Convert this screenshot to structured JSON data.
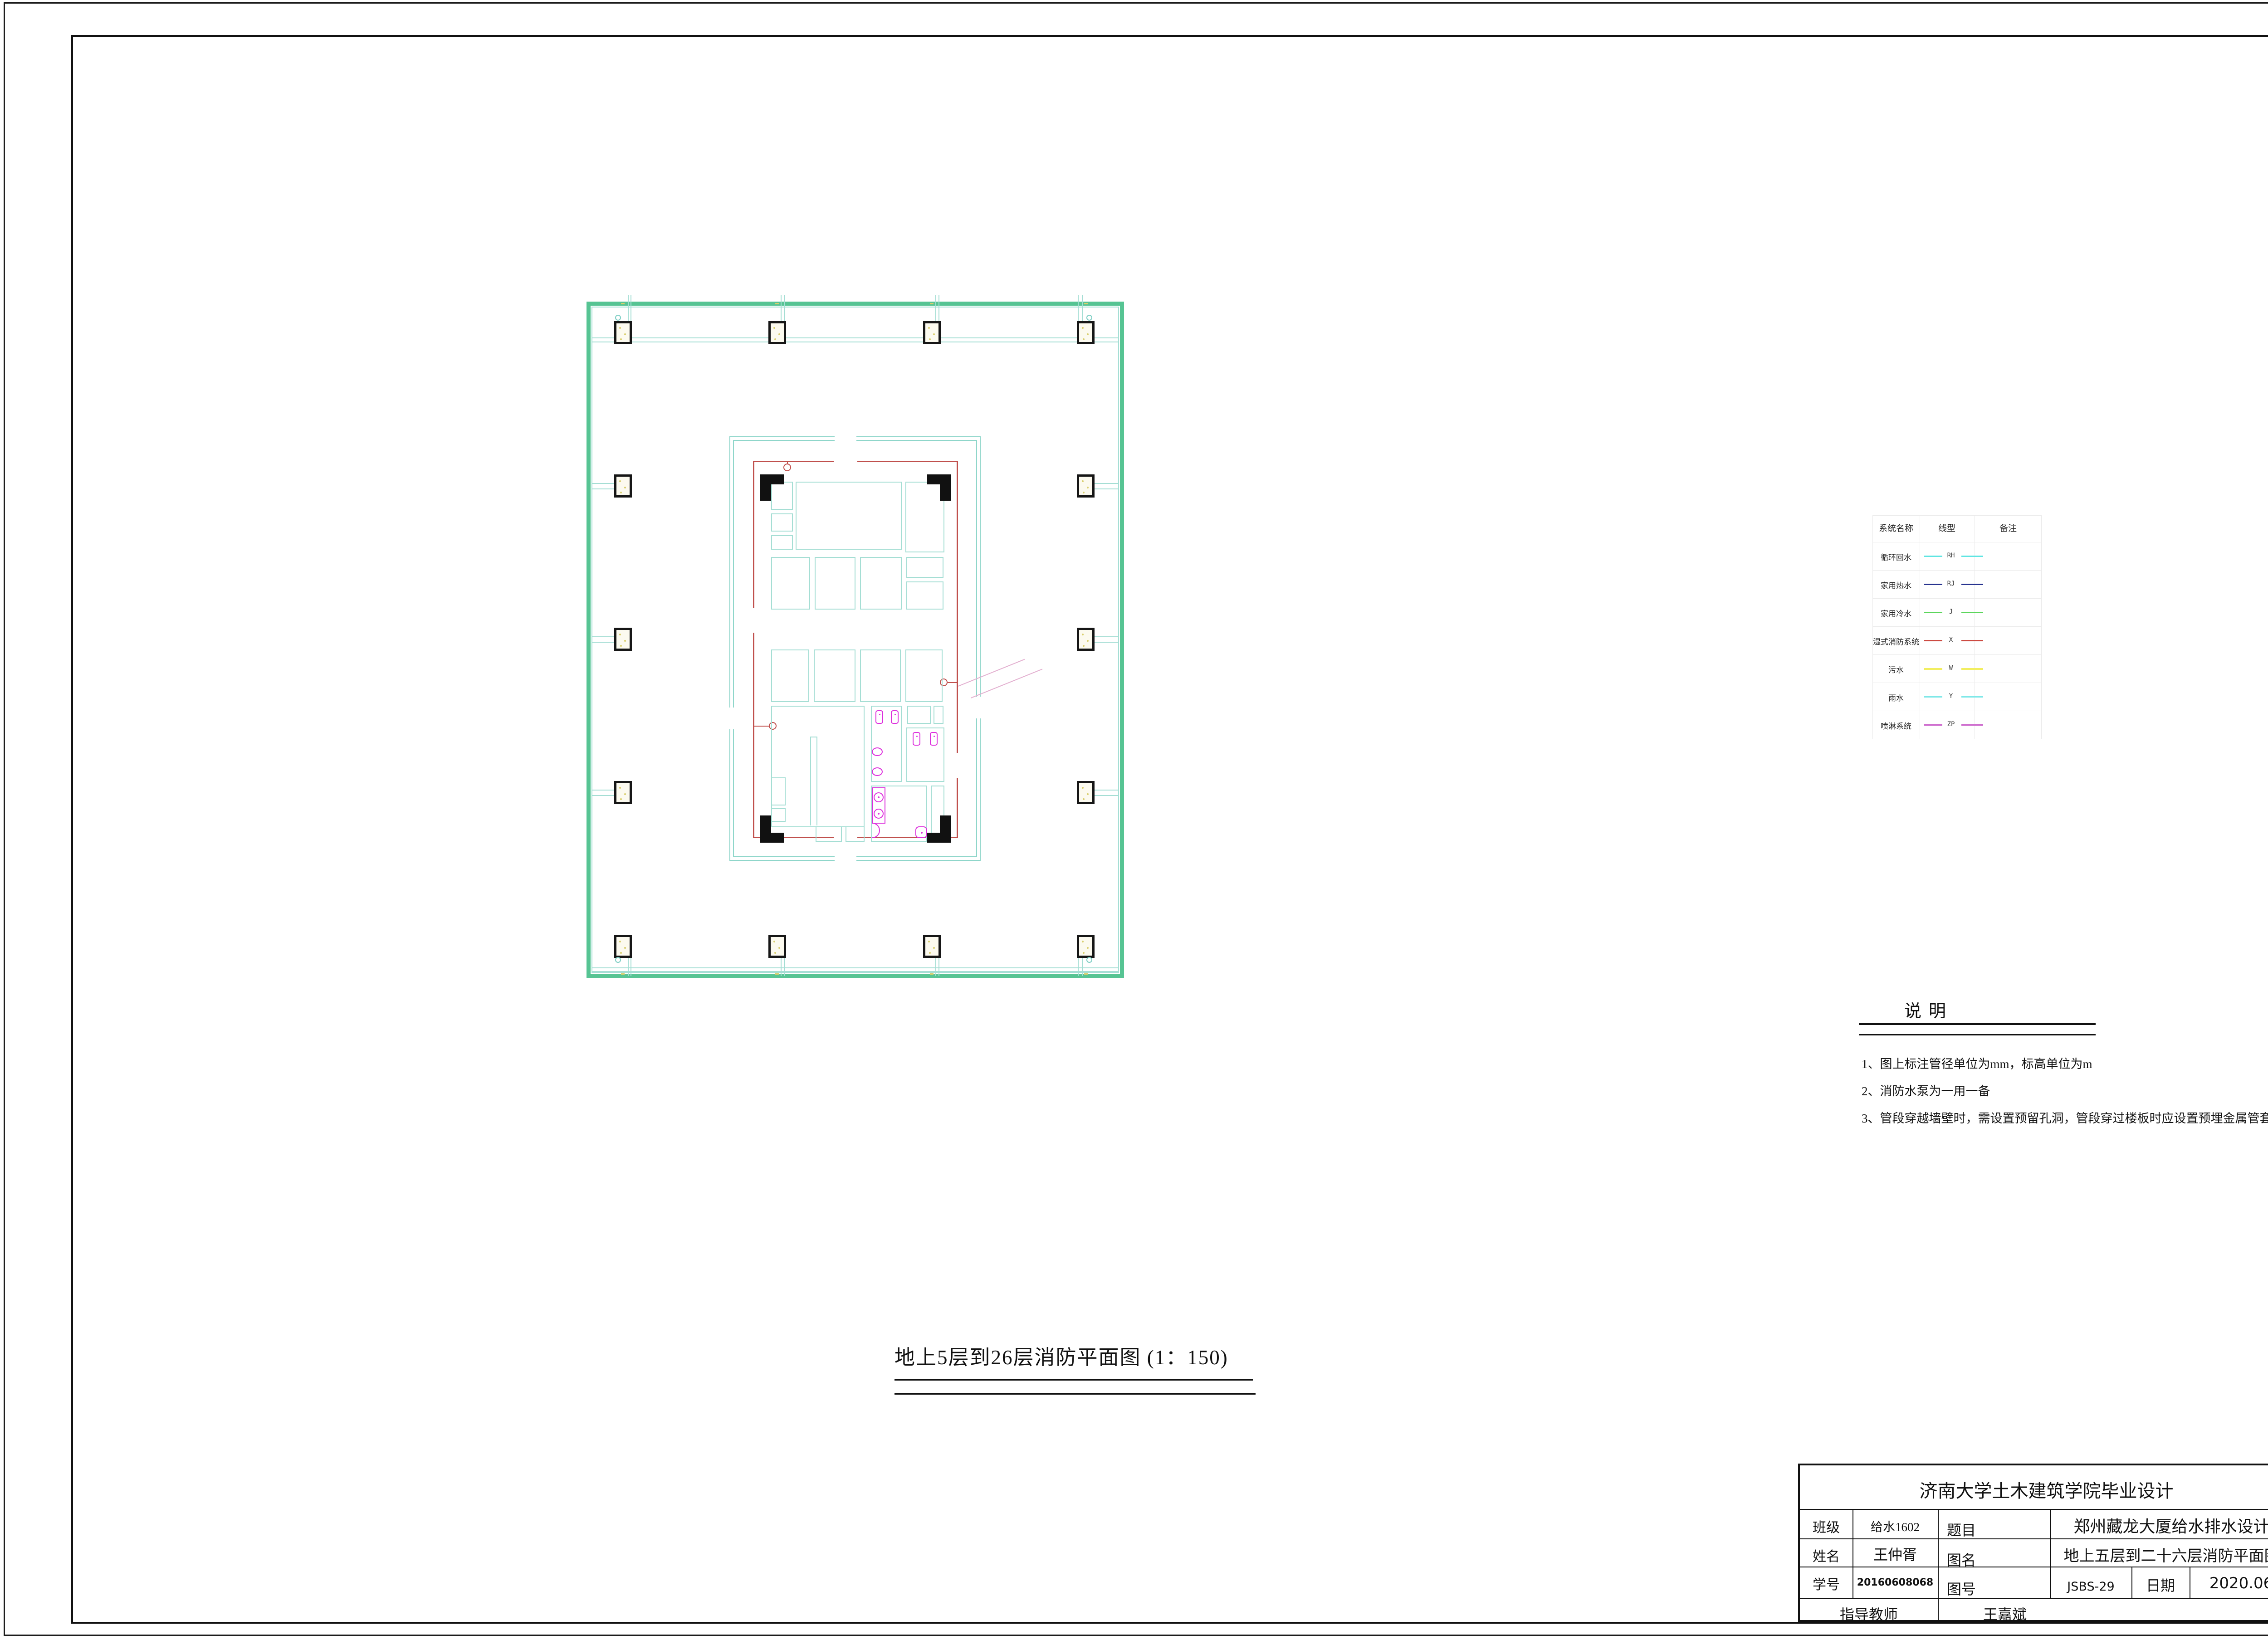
{
  "sheet": {
    "type_label": "CAD fire-protection floor plan sheet",
    "colors": {
      "plan_green": "#56C493",
      "wall_teal": "#A5DED4",
      "fire_main_red": "#C0504D",
      "fixture_magenta": "#DD30DD",
      "column_fleck_yellow": "#D9CF6E",
      "frame_black": "#111111"
    }
  },
  "legend": {
    "headers": [
      "系统名称",
      "线型",
      "备注"
    ],
    "rows": [
      {
        "name": "循环回水",
        "code": "RH",
        "color": "#5FE5E2"
      },
      {
        "name": "家用热水",
        "code": "RJ",
        "color": "#27338F"
      },
      {
        "name": "家用冷水",
        "code": "J",
        "color": "#5CD65C"
      },
      {
        "name": "湿式消防系统",
        "code": "X",
        "color": "#CC4B42"
      },
      {
        "name": "污水",
        "code": "W",
        "color": "#F2EE60"
      },
      {
        "name": "雨水",
        "code": "Y",
        "color": "#7FE8E8"
      },
      {
        "name": "喷淋系统",
        "code": "ZP",
        "color": "#CC66CC"
      }
    ]
  },
  "notes": {
    "title": "说明",
    "items": [
      "1、图上标注管径单位为mm，标高单位为m",
      "2、消防水泵为一用一备",
      "3、管段穿越墙壁时，需设置预留孔洞，管段穿过楼板时应设置预埋金属管套"
    ]
  },
  "drawing_caption": "地上5层到26层消防平面图 (1：150)",
  "title_block": {
    "header": "济南大学土木建筑学院毕业设计",
    "class_label": "班级",
    "class_value": "给水1602",
    "subject_label": "题目",
    "subject_value": "郑州藏龙大厦给水排水设计",
    "name_label": "姓名",
    "name_value": "王仲胥",
    "drawing_name_label": "图名",
    "drawing_name_value": "地上五层到二十六层消防平面图",
    "student_id_label": "学号",
    "student_id_value": "20160608068",
    "drawing_no_label": "图号",
    "drawing_no_value": "JSBS-29",
    "date_label": "日期",
    "date_value": "2020.06",
    "advisor_label": "指导教师",
    "advisor_value": "王嘉斌"
  }
}
